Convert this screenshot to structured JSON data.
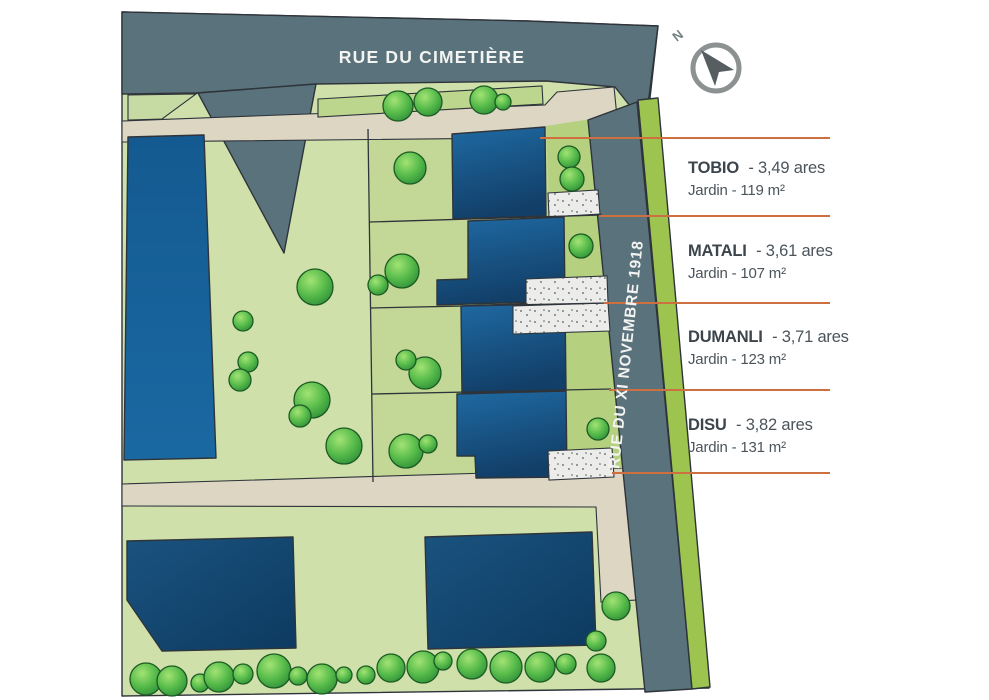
{
  "streets": {
    "top": "RUE DU CIMETIÈRE",
    "side": "RUE DU XI NOVEMBRE 1918"
  },
  "compass": {
    "north": "N"
  },
  "lots": [
    {
      "name": "TOBIO",
      "area": "- 3,49 ares",
      "garden": "Jardin - 119 m²"
    },
    {
      "name": "MATALI",
      "area": "- 3,61 ares",
      "garden": "Jardin - 107 m²"
    },
    {
      "name": "DUMANLI",
      "area": "- 3,71 ares",
      "garden": "Jardin - 131 m²"
    },
    {
      "name": "DISU",
      "area": "- 3,82 ares",
      "garden": "Jardin - 131 m²"
    }
  ],
  "lots_fix": [
    {
      "name": "DUMANLI",
      "garden": "Jardin - 123 m²"
    }
  ],
  "colors": {
    "road_gray": "#5a727b",
    "lawn_light": "#cfe0ab",
    "lawn_lot": "#c3d897",
    "lawn_dark": "#b5d180",
    "roadside_green": "#9cc44f",
    "path_beige": "#ddd6c3",
    "gravel": "#ecedea",
    "building_blue": "#1c649e",
    "accent_line": "#cd6f3e",
    "label_text": "#3c454c"
  }
}
